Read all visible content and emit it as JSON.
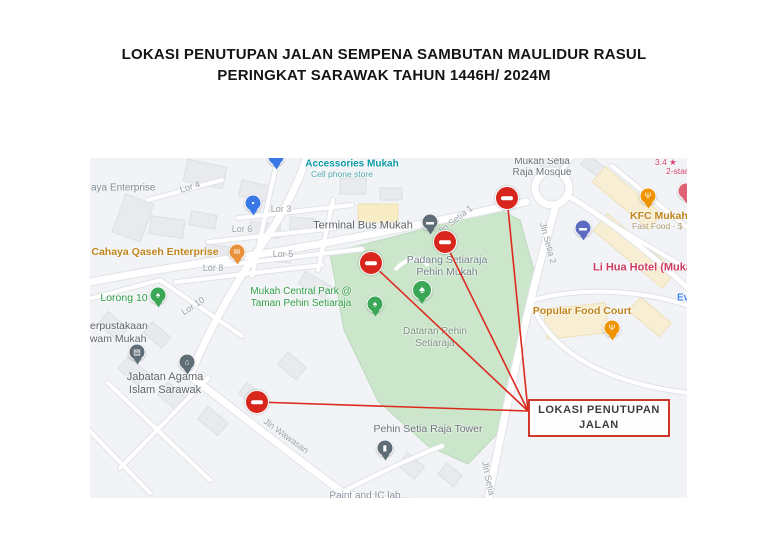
{
  "title": {
    "line1": "LOKASI PENUTUPAN JALAN SEMPENA SAMBUTAN MAULIDUR RASUL",
    "line2": "PERINGKAT SARAWAK TAHUN 1446H/ 2024M"
  },
  "colors": {
    "closure_red": "#d8261c",
    "line_red": "#dc2a1e",
    "park_green_fill": "#cbe6cb",
    "poi_gray": "#5f6368",
    "street_gray": "#9ba1a6",
    "poi_orange": "#c0841a",
    "poi_green": "#2f9e44",
    "poi_teal": "#0e9aa7",
    "poi_pink": "#cf3d64",
    "poi_blue": "#4285f4"
  },
  "map": {
    "callout": {
      "x": 438,
      "y": 241,
      "w": 138,
      "h": 34,
      "line1": "LOKASI PENUTUPAN",
      "line2": "JALAN"
    },
    "convergence": {
      "x": 438,
      "y": 253
    },
    "closures": [
      {
        "name": "road-closure-jln-setia-1",
        "x": 417,
        "y": 40
      },
      {
        "name": "road-closure-terminal-bus",
        "x": 355,
        "y": 84
      },
      {
        "name": "road-closure-padang-west",
        "x": 281,
        "y": 105
      },
      {
        "name": "road-closure-jln-wawasan",
        "x": 167,
        "y": 244
      }
    ],
    "labels": [
      {
        "name": "accessories-mukah",
        "lines": [
          "Accessories Mukah"
        ],
        "x": 262,
        "y": 6,
        "color": "#0e9aa7",
        "size": 10,
        "bold": true
      },
      {
        "name": "accessories-mukah-sub",
        "lines": [
          "Cell phone store"
        ],
        "x": 252,
        "y": 17,
        "color": "#4fa8ae",
        "size": 8.5
      },
      {
        "name": "jaya-enterprise",
        "lines": [
          "aya Enterprise"
        ],
        "x": 1,
        "y": 30,
        "color": "#7e8a93",
        "size": 10,
        "align": "left"
      },
      {
        "name": "street-lor-4",
        "lines": [
          "Lor 4"
        ],
        "x": 100,
        "y": 29,
        "color": "#9ba1a6",
        "size": 9,
        "rot": -18
      },
      {
        "name": "street-lor-3",
        "lines": [
          "Lor 3"
        ],
        "x": 191,
        "y": 51,
        "color": "#9ba1a6",
        "size": 9
      },
      {
        "name": "street-lor-6",
        "lines": [
          "Lor 6"
        ],
        "x": 152,
        "y": 71,
        "color": "#9ba1a6",
        "size": 9
      },
      {
        "name": "street-lor-5",
        "lines": [
          "Lor 5"
        ],
        "x": 193,
        "y": 96,
        "color": "#9ba1a6",
        "size": 9
      },
      {
        "name": "street-lor-8",
        "lines": [
          "Lor 8"
        ],
        "x": 123,
        "y": 110,
        "color": "#9ba1a6",
        "size": 9
      },
      {
        "name": "cahaya-qaseh-enterprise",
        "lines": [
          "Cahaya Qaseh Enterprise"
        ],
        "x": 65,
        "y": 94,
        "color": "#c0841a",
        "size": 10.5,
        "bold": true
      },
      {
        "name": "terminal-bus-mukah",
        "lines": [
          "Terminal Bus Mukah"
        ],
        "x": 273,
        "y": 68,
        "color": "#5f6368",
        "size": 11
      },
      {
        "name": "street-jln-setia-1",
        "lines": [
          "Jln Setia 1"
        ],
        "x": 365,
        "y": 62,
        "color": "#9ba1a6",
        "size": 9,
        "rot": -38
      },
      {
        "name": "mukah-setia-raja-mosque",
        "lines": [
          "Mukah Setia",
          "Raja Mosque"
        ],
        "x": 452,
        "y": 9,
        "color": "#6a737a",
        "size": 10,
        "lh": 11
      },
      {
        "name": "kfc-mukah",
        "lines": [
          "KFC Mukah"
        ],
        "x": 540,
        "y": 58,
        "color": "#c0841a",
        "size": 10.5,
        "bold": true,
        "align": "left"
      },
      {
        "name": "kfc-mukah-sub",
        "lines": [
          "Fast Food · $"
        ],
        "x": 542,
        "y": 69,
        "color": "#b09a70",
        "size": 8.5,
        "align": "left"
      },
      {
        "name": "rating-value",
        "lines": [
          "3.4 ★"
        ],
        "x": 565,
        "y": 5,
        "color": "#d2416b",
        "size": 8.5,
        "align": "left"
      },
      {
        "name": "rating-class",
        "lines": [
          "2-star"
        ],
        "x": 576,
        "y": 14,
        "color": "#d2416b",
        "size": 8.5,
        "align": "left"
      },
      {
        "name": "li-hua-hotel",
        "lines": [
          "Li Hua Hotel (Mukah)"
        ],
        "x": 503,
        "y": 110,
        "color": "#cf3d64",
        "size": 11,
        "bold": true,
        "align": "left"
      },
      {
        "name": "street-jln-setia-2-upper",
        "lines": [
          "Jln Setia 2"
        ],
        "x": 458,
        "y": 85,
        "color": "#9ba1a6",
        "size": 9,
        "rot": 75
      },
      {
        "name": "popular-food-court",
        "lines": [
          "Popular Food Court"
        ],
        "x": 492,
        "y": 153,
        "color": "#c0841a",
        "size": 10.5,
        "bold": true
      },
      {
        "name": "everwin",
        "lines": [
          "Ev"
        ],
        "x": 587,
        "y": 140,
        "color": "#4285f4",
        "size": 10,
        "bold": true,
        "align": "left"
      },
      {
        "name": "lorong-10",
        "lines": [
          "Lorong 10"
        ],
        "x": 34,
        "y": 140,
        "color": "#2f9e44",
        "size": 10.5
      },
      {
        "name": "street-lor-10",
        "lines": [
          "Lor 10"
        ],
        "x": 103,
        "y": 148,
        "color": "#9ba1a6",
        "size": 9,
        "rot": -33
      },
      {
        "name": "mukah-central-park",
        "lines": [
          "Mukah Central Park @",
          "Taman Pehin Setiaraja"
        ],
        "x": 211,
        "y": 140,
        "color": "#2f9e44",
        "size": 10,
        "lh": 12
      },
      {
        "name": "padang-setiaraja-pehin-mukah",
        "lines": [
          "Padang Setiaraja",
          "Pehin Mukah"
        ],
        "x": 357,
        "y": 108,
        "color": "#73808a",
        "size": 10.5,
        "lh": 12
      },
      {
        "name": "dataran-pehin-setiaraja",
        "lines": [
          "Dataran Pehin",
          "Setiaraja"
        ],
        "x": 345,
        "y": 180,
        "color": "#7d917f",
        "size": 10,
        "lh": 12
      },
      {
        "name": "perpustakaan-awam-mukah",
        "lines": [
          "Perpustakaan",
          "Awam Mukah"
        ],
        "x": -7,
        "y": 175,
        "color": "#5f6368",
        "size": 10.5,
        "lh": 13,
        "align": "left"
      },
      {
        "name": "jabatan-agama-islam-sarawak",
        "lines": [
          "Jabatan Agama",
          "Islam Sarawak"
        ],
        "x": 75,
        "y": 226,
        "color": "#5f6368",
        "size": 11,
        "lh": 13
      },
      {
        "name": "street-jln-wawasan",
        "lines": [
          "Jln Wawasan"
        ],
        "x": 196,
        "y": 278,
        "color": "#9ba1a6",
        "size": 9,
        "rot": 36
      },
      {
        "name": "pehin-setia-raja-tower",
        "lines": [
          "Pehin Setia Raja Tower"
        ],
        "x": 338,
        "y": 271,
        "color": "#6a737a",
        "size": 10.5
      },
      {
        "name": "street-jln-setia-2-lower",
        "lines": [
          "Jln Setia 2"
        ],
        "x": 399,
        "y": 324,
        "color": "#9ba1a6",
        "size": 9,
        "rot": 78
      },
      {
        "name": "paint-ic-lab",
        "lines": [
          "Paint and IC lab"
        ],
        "x": 275,
        "y": 338,
        "color": "#8a93a0",
        "size": 10
      }
    ],
    "pins": [
      {
        "name": "accessories-mukah-pin",
        "x": 186,
        "y": -1,
        "color": "#3b78e7",
        "glyph": ""
      },
      {
        "name": "business-pin",
        "x": 163,
        "y": 45,
        "color": "#3b78e7",
        "glyph": "▪"
      },
      {
        "name": "cahaya-qaseh-pin",
        "x": 147,
        "y": 94,
        "color": "#e8903a",
        "glyph": "✉"
      },
      {
        "name": "terminal-bus-pin",
        "x": 340,
        "y": 64,
        "color": "#5f6d77",
        "glyph": "▬"
      },
      {
        "name": "lorong-10-park-pin",
        "x": 68,
        "y": 137,
        "color": "#3aa757",
        "glyph": "♠"
      },
      {
        "name": "central-park-pin",
        "x": 285,
        "y": 146,
        "color": "#3aa757",
        "glyph": "♠"
      },
      {
        "name": "padang-park-pin",
        "x": 332,
        "y": 132,
        "color": "#3aa757",
        "glyph": "♠",
        "s": 18
      },
      {
        "name": "library-pin",
        "x": 47,
        "y": 194,
        "color": "#5f6d77",
        "glyph": "▤"
      },
      {
        "name": "government-pin",
        "x": 97,
        "y": 204,
        "color": "#5f6d77",
        "glyph": "⌂"
      },
      {
        "name": "tower-pin",
        "x": 295,
        "y": 290,
        "color": "#5f6d77",
        "glyph": "▮"
      },
      {
        "name": "hotel-pin",
        "x": 493,
        "y": 70,
        "color": "#5c6bc0",
        "glyph": "▬"
      },
      {
        "name": "kfc-pin",
        "x": 558,
        "y": 38,
        "color": "#f09300",
        "glyph": "Ψ"
      },
      {
        "name": "popular-food-court-pin",
        "x": 522,
        "y": 170,
        "color": "#f09300",
        "glyph": "Ψ"
      },
      {
        "name": "clipped-pink-pin",
        "x": 596,
        "y": 33,
        "color": "#e06277",
        "glyph": ""
      }
    ]
  }
}
